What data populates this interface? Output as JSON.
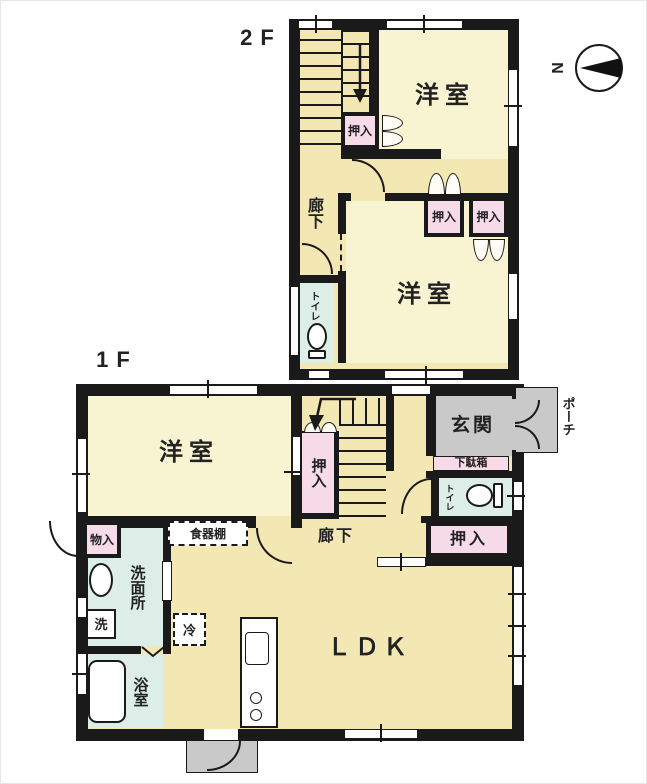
{
  "floor2": {
    "label": "2F",
    "rooms": {
      "bedroom_upper": "洋室",
      "bedroom_lower": "洋室",
      "closet_stairs": "押入",
      "closet_left": "押入",
      "closet_right": "押入",
      "hallway": "廊下",
      "toilet": "トイレ"
    }
  },
  "floor1": {
    "label": "1F",
    "rooms": {
      "bedroom": "洋室",
      "closet_stairs": "押入",
      "closet_hall": "押入",
      "entrance": "玄関",
      "shoe_cabinet": "下駄箱",
      "porch": "ポーチ",
      "toilet": "トイレ",
      "storage": "物入",
      "washroom": "洗面所",
      "laundry": "洗",
      "bathroom": "浴室",
      "cupboard": "食器棚",
      "refrigerator": "冷",
      "ldk": "ＬＤＫ",
      "hallway": "廊下"
    }
  },
  "compass": {
    "north_label": "N"
  },
  "palette": {
    "wall": "#1a1a1a",
    "room_yellow": "#f8f3d0",
    "hall_cream": "#f3e7b4",
    "closet_pink": "#f7dbe8",
    "wet_cyan": "#ddeee9",
    "entry_gray": "#c9c9c9"
  }
}
